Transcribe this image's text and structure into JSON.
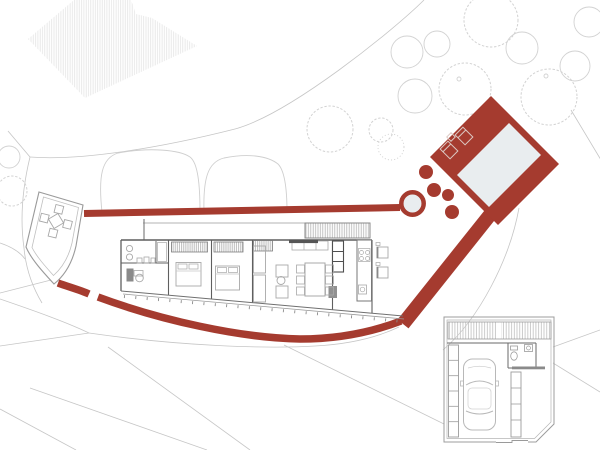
{
  "colors": {
    "background": "#ffffff",
    "accent": "#a53b2f",
    "water": "#e9edef",
    "contour": "#c6c6c6",
    "tree": "#d2d2d2",
    "bush": "#cfcfcf",
    "wall": "#5f5f5f",
    "wallLight": "#9a9a9a",
    "furniture": "#a8a8a8",
    "furnitureDark": "#8a8a8a",
    "hatchNeighbor": "#e4e4e4",
    "hatchWood": "#b3b3b3",
    "hatchGarage": "#c6c6c6",
    "garage": "#9c9c9c",
    "deckFurniture": "#dcc9c4"
  }
}
